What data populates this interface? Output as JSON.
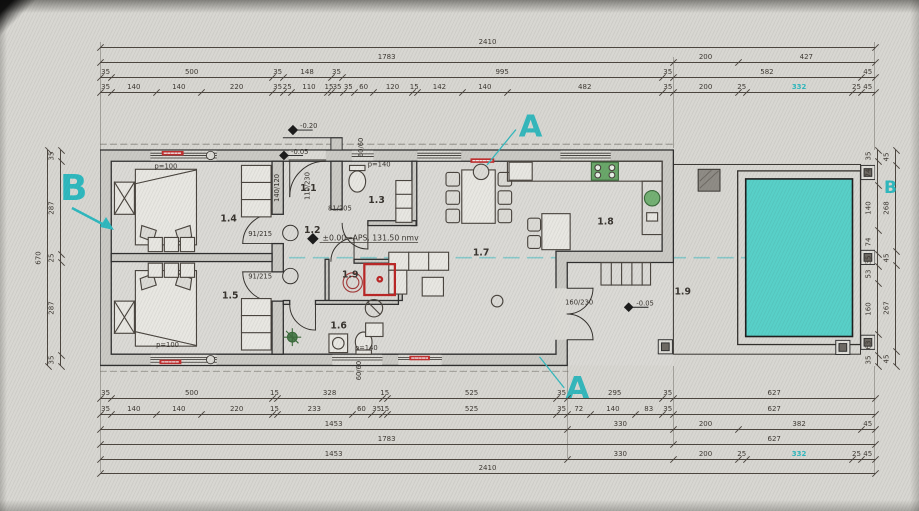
{
  "datum_text": "±0.00=APS. 131.50 nmv",
  "levels": {
    "outside": "-0.20",
    "entry": "-0.05",
    "terrace": "-0.05"
  },
  "rooms": {
    "r11": "1.1",
    "r12": "1.2",
    "r13": "1.3",
    "r14": "1.4",
    "r15": "1.5",
    "r16": "1.6",
    "r17": "1.7",
    "r18": "1.8",
    "r19_utility": "1.9",
    "r19_terrace": "1.9"
  },
  "openings": {
    "entry_door": "110/230",
    "hall_window": "140/120",
    "wc_window": "60/60",
    "wc_door": "81/205",
    "bedroom_door_1": "91/215",
    "bedroom_door_2": "91/215",
    "terrace_door": "160/230",
    "bath_window": "60/60",
    "parapet_bedroom_top": "p=100",
    "parapet_bedroom_bottom": "p=100",
    "parapet_wc": "p=140",
    "parapet_bath": "p=140"
  },
  "section_markers": {
    "a_top": "A",
    "a_bottom": "A",
    "b_left": "B",
    "b_right": "B"
  },
  "dimensions": {
    "top": {
      "row1": [
        "2410"
      ],
      "row2": [
        "1783",
        "200",
        "427"
      ],
      "row3": [
        "35",
        "500",
        "35",
        "148",
        "35",
        "995",
        "35",
        "582",
        "45"
      ],
      "row4": [
        "35",
        "140",
        "140",
        "220",
        "35",
        "25",
        "110",
        "15",
        "35",
        "35",
        "60",
        "120",
        "15",
        "142",
        "140",
        "482",
        "35",
        "200",
        "25",
        {
          "v": "332",
          "accent": true
        },
        "25",
        "45"
      ]
    },
    "bottom": {
      "row1": [
        "35",
        "500",
        "15",
        "328",
        "15",
        "525",
        "35",
        "295",
        "35",
        "627"
      ],
      "row2": [
        "35",
        "140",
        "140",
        "220",
        "15",
        "233",
        "60",
        "35",
        "15",
        "525",
        "35",
        "72",
        "140",
        "83",
        "35",
        "627"
      ],
      "row3": [
        "1453",
        "330",
        "200",
        "382",
        "45"
      ],
      "row4": [
        "1783",
        "627"
      ],
      "row5": [
        "1453",
        "330",
        "200",
        "25",
        {
          "v": "332",
          "accent": true
        },
        "25",
        "45"
      ],
      "row6": [
        "2410"
      ]
    },
    "left": {
      "total": [
        "670"
      ],
      "segments": [
        "35",
        "287",
        "25",
        "287",
        "35"
      ]
    },
    "right": {
      "inner": [
        "35",
        "74",
        "140",
        "74",
        "35",
        "53",
        "160",
        "63",
        "35"
      ],
      "outer": [
        "45",
        "268",
        "45",
        "267",
        "45"
      ]
    }
  },
  "colors": {
    "section_cyan": "#2fb9bf",
    "pool_fill": "#58d0c8",
    "wall": "#2f2f2f",
    "red_tag": "#c03030",
    "green_fixture": "#5f9e5f",
    "dim_text": "#3e3933"
  }
}
